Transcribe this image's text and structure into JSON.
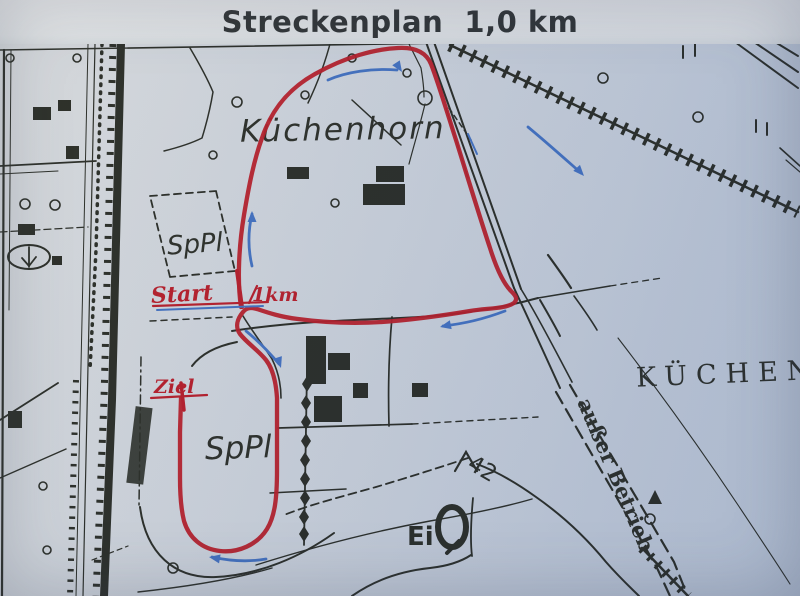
{
  "title": "Streckenplan  1,0 km",
  "colors": {
    "route_red": "#b2131f",
    "marker_blue": "#3a6abc",
    "ink": "#20231c",
    "paper": "#e3e5e6",
    "map_paper": "#c7ced9"
  },
  "map": {
    "labels": {
      "forest_area": "Küchenhorn",
      "sports_fields": [
        "SpPl",
        "SpPl"
      ],
      "district_right": "KÜCHEN",
      "railway_note": "außer Betrieb",
      "point_label": "Ei",
      "elevation": "42"
    },
    "course": {
      "start": "Start",
      "distance": "1km",
      "finish": "Ziel"
    },
    "icons": {
      "direction_arrow": "blue-curved-arrow",
      "water_tower": "bold-ellipse-tail",
      "trig_point": "caret-peak",
      "railway_embankment": "toothed-band"
    }
  }
}
